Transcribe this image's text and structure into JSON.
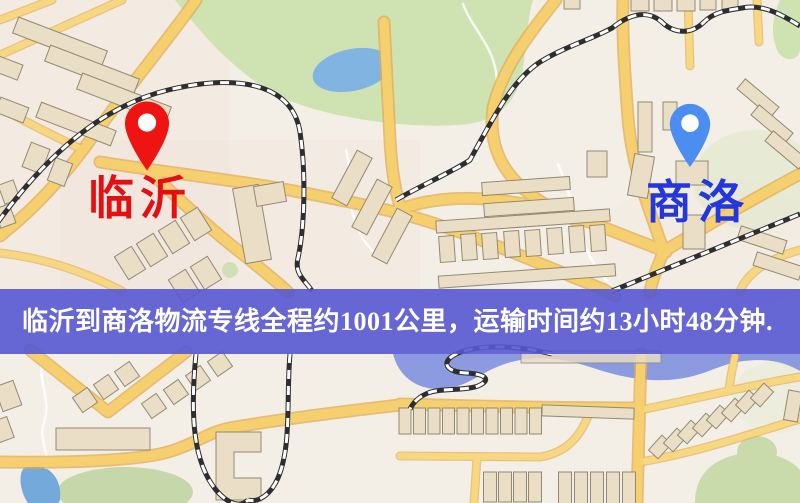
{
  "banner": {
    "text": "临沂到商洛物流专线全程约1001公里，运输时间约13小时48分钟.",
    "bg_color": "#5757d3",
    "text_color": "#ffffff"
  },
  "markers": {
    "origin": {
      "name": "临沂",
      "pin_color": "#ee1411",
      "pin_hole_color": "#ffffff",
      "label_color": "#e40f12"
    },
    "destination": {
      "name": "商洛",
      "pin_color": "#4b8df0",
      "pin_hole_color": "#ffffff",
      "label_color": "#2337dd"
    }
  },
  "map_palette": {
    "base": "#f4efe6",
    "road": "#f6d06e",
    "road_casing": "#e2ab52",
    "water": "#8c9be0",
    "lake": "#82b4e2",
    "pond": "#74a9dc",
    "park": "#cfe3b2",
    "building": "#eadfc6",
    "railway": "#2e2e30"
  }
}
